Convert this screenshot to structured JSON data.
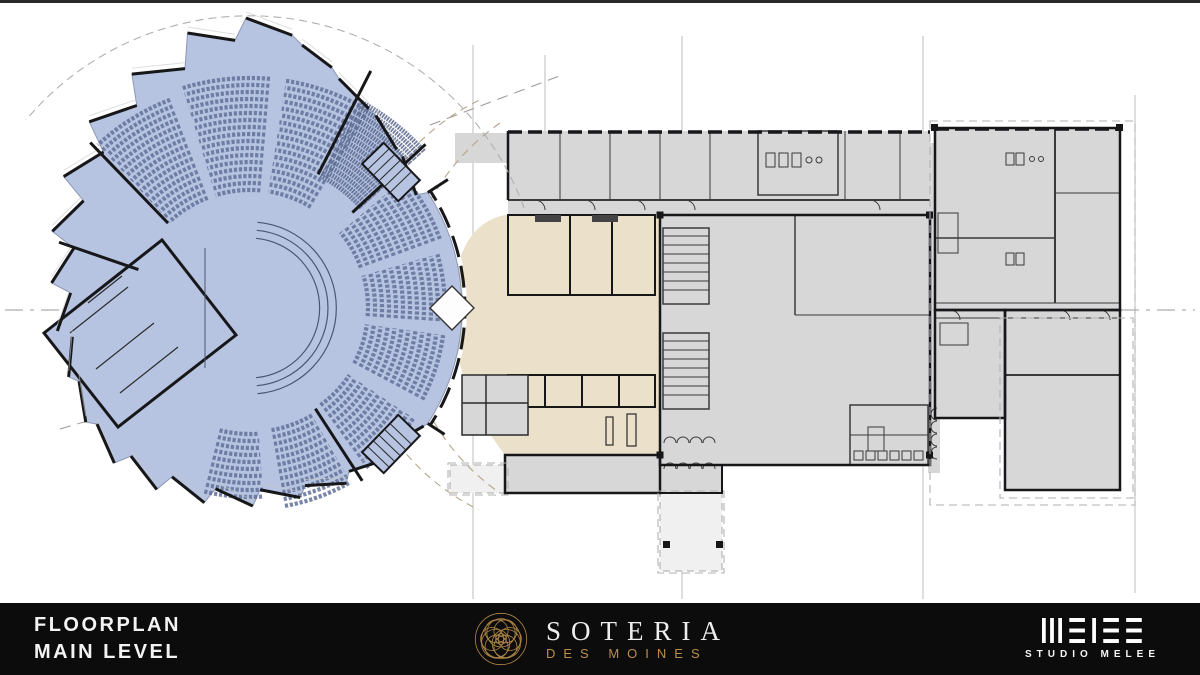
{
  "slide": {
    "title_line1": "FLOORPLAN",
    "title_line2": "MAIN LEVEL"
  },
  "brand": {
    "name": "SOTERIA",
    "tagline": "DES MOINES"
  },
  "studio": {
    "wordmark": "MELEE",
    "label": "STUDIO MELEE"
  },
  "colors": {
    "footer_bg": "#0c0c0c",
    "text_light": "#f3f3f3",
    "gold": "#bb8f4a",
    "auditorium_blue": "#b6c4e1",
    "seat_line": "#63719a",
    "lobby_beige": "#ebe1cb",
    "room_gray": "#d7d7d7",
    "canopy_gray": "#f0f0f0",
    "wall_dark": "#17171a",
    "grid_gray": "#bdbdbd"
  }
}
